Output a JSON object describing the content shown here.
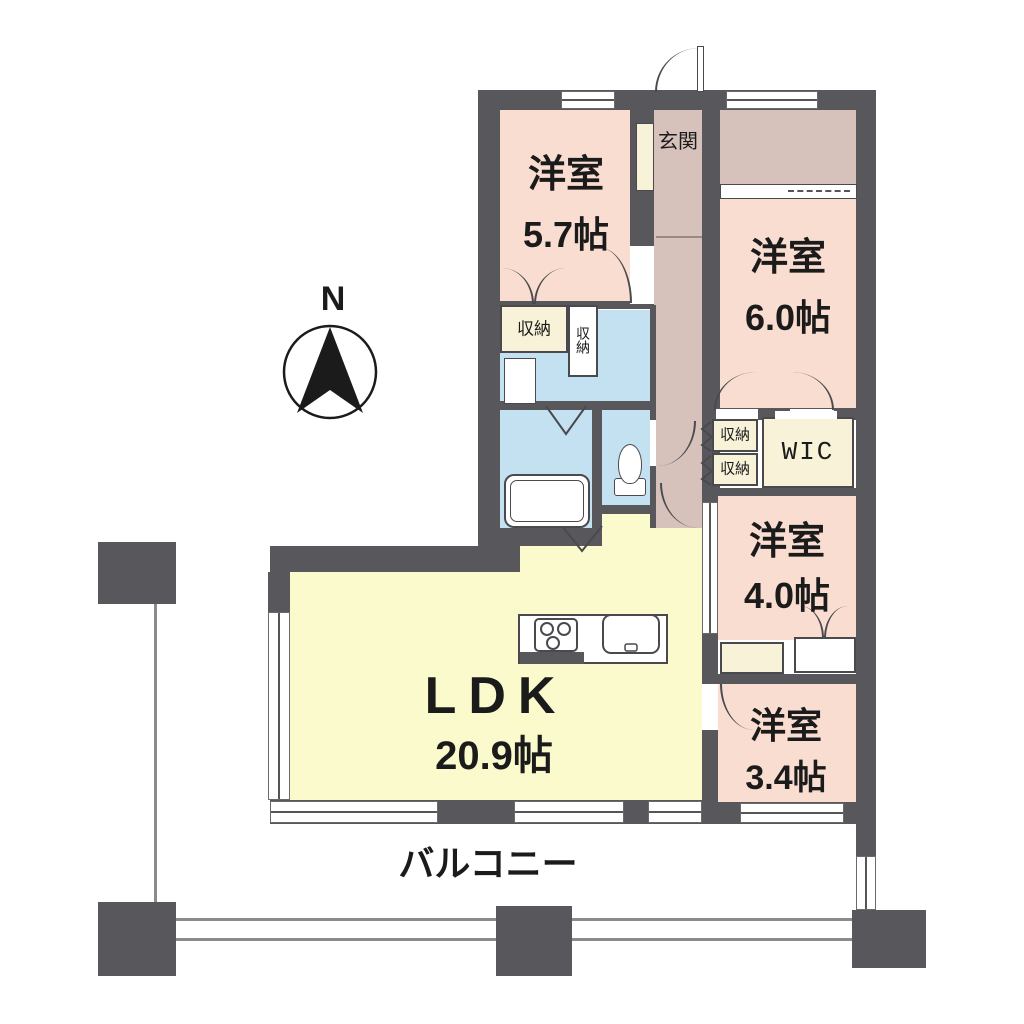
{
  "compass": {
    "label": "N"
  },
  "rooms": {
    "bedroom57": {
      "name": "洋室",
      "size": "5.7帖"
    },
    "bedroom60": {
      "name": "洋室",
      "size": "6.0帖"
    },
    "bedroom40": {
      "name": "洋室",
      "size": "4.0帖"
    },
    "bedroom34": {
      "name": "洋室",
      "size": "3.4帖"
    },
    "ldk": {
      "name": "LDK",
      "size": "20.9帖"
    },
    "genkan": {
      "label": "玄関"
    },
    "balcony": {
      "label": "バルコニー"
    },
    "wic": {
      "label": "WIC"
    },
    "storage": {
      "label": "収納"
    }
  },
  "colors": {
    "wall": "#58585c",
    "bedroom_fill": "#f8ddd0",
    "entry_fill": "#d6c2bb",
    "ldk_fill": "#fafacd",
    "wet_area_fill": "#c4e1f2",
    "closet_fill": "#f7f2d8"
  }
}
